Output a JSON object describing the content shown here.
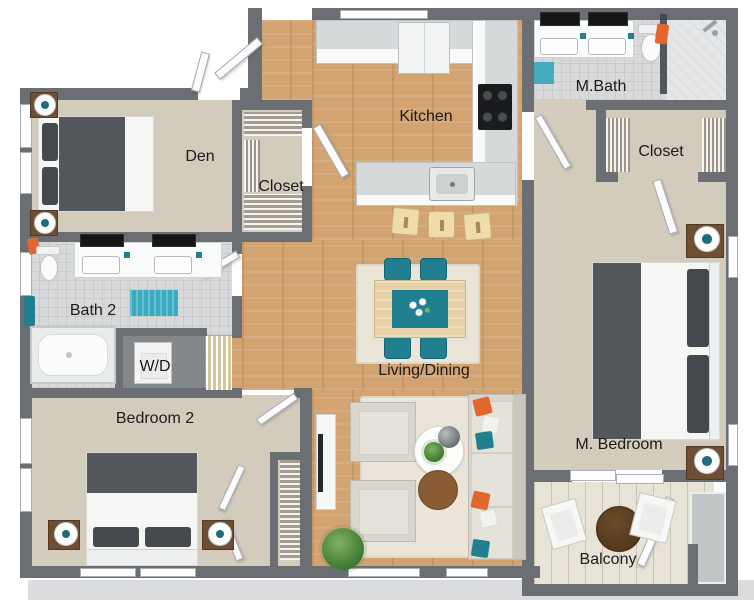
{
  "rooms": [
    {
      "label": "Den"
    },
    {
      "label": "Closet"
    },
    {
      "label": "Kitchen"
    },
    {
      "label": "M.Bath"
    },
    {
      "label": "Closet"
    },
    {
      "label": "Bath 2"
    },
    {
      "label": "W/D"
    },
    {
      "label": "Bedroom 2"
    },
    {
      "label": "Living/Dining"
    },
    {
      "label": "M. Bedroom"
    },
    {
      "label": "Balcony"
    }
  ],
  "colors": {
    "wall": "#6b6f73",
    "floor_beige": "#d3cbbb",
    "floor_wood": "#d3a472",
    "floor_tile": "#d7d9da",
    "floor_balcony": "#e8e3d7",
    "accent_teal": "#21808f",
    "accent_orange": "#e2672f",
    "furniture_dark": "#53565b",
    "furniture_brown": "#6f4f33",
    "fabric_light": "#d8d6cd",
    "rug_cream": "#eae5d8"
  }
}
